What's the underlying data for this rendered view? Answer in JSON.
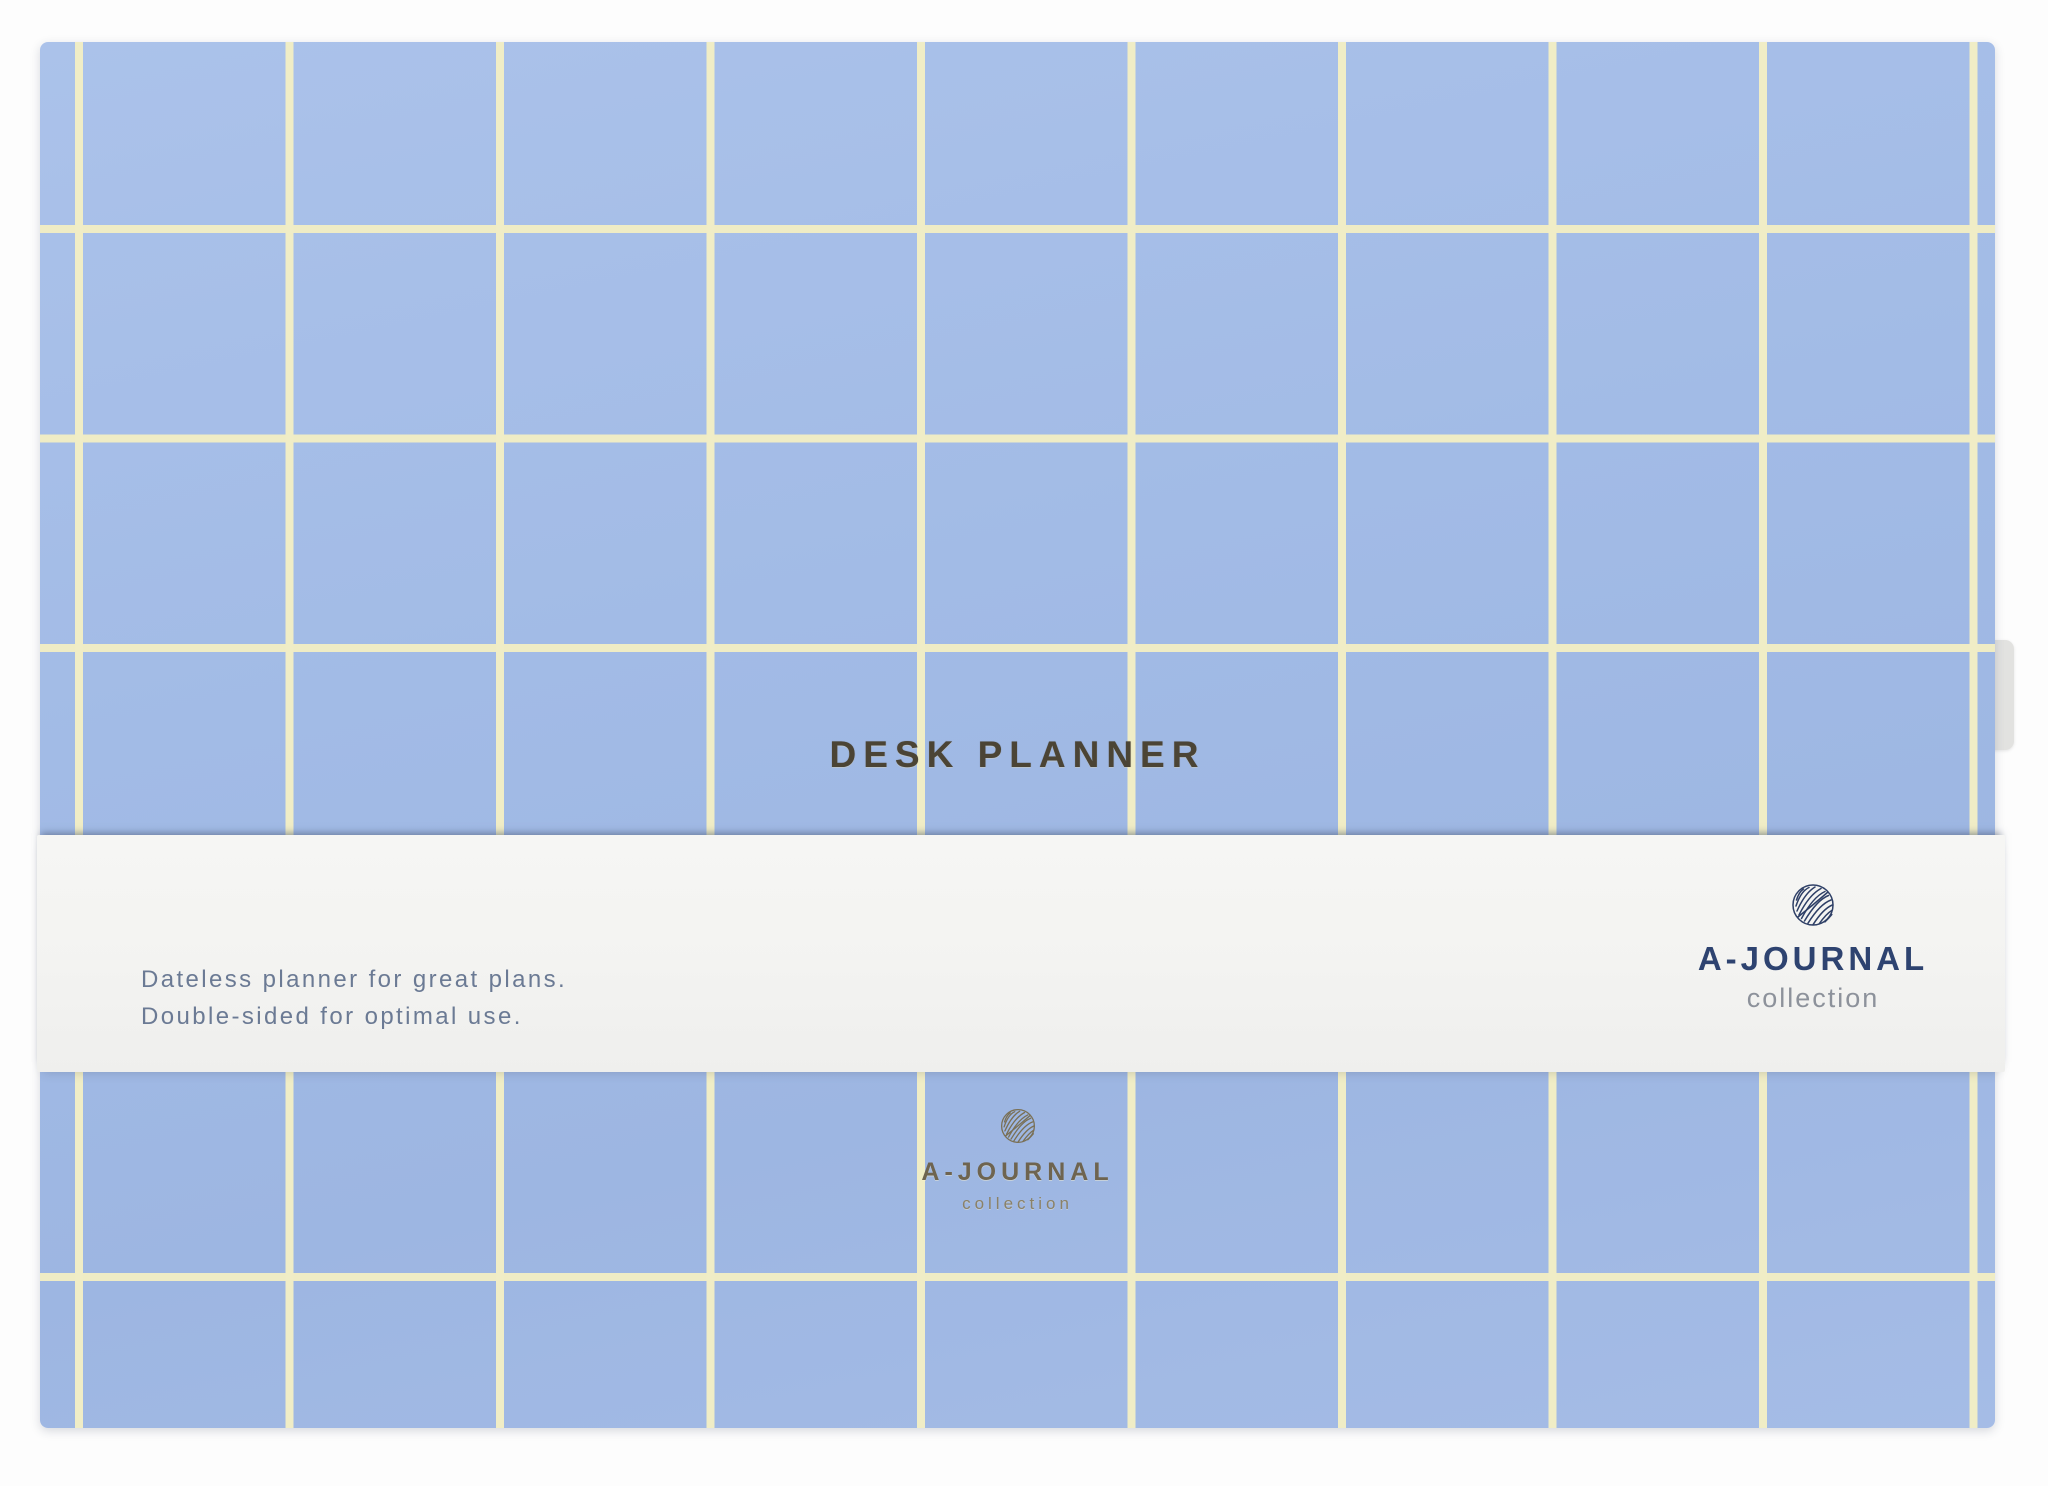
{
  "product": {
    "type": "photo of a dateless desk planner with belly band",
    "cover": {
      "title": "DESK PLANNER",
      "brand": {
        "name": "A-JOURNAL",
        "sub": "collection"
      },
      "logo_icon": "leaf-in-circle"
    },
    "band": {
      "tagline_line1": "Dateless planner for great plans.",
      "tagline_line2": "Double-sided for optimal use.",
      "brand": {
        "name": "A-JOURNAL",
        "sub": "collection"
      },
      "logo_icon": "leaf-in-circle"
    },
    "colors": {
      "cover_blue": "#a2bbe6",
      "grid_yellow": "#f0edc6",
      "band_white": "#f3f3f1",
      "title_foil": "#4b4435",
      "gold_foil": "#6e6450",
      "brand_navy": "#2e4370",
      "brand_gray": "#8d929b",
      "tagline_gray_blue": "#6b7a94",
      "background": "#fdfdfd"
    }
  }
}
